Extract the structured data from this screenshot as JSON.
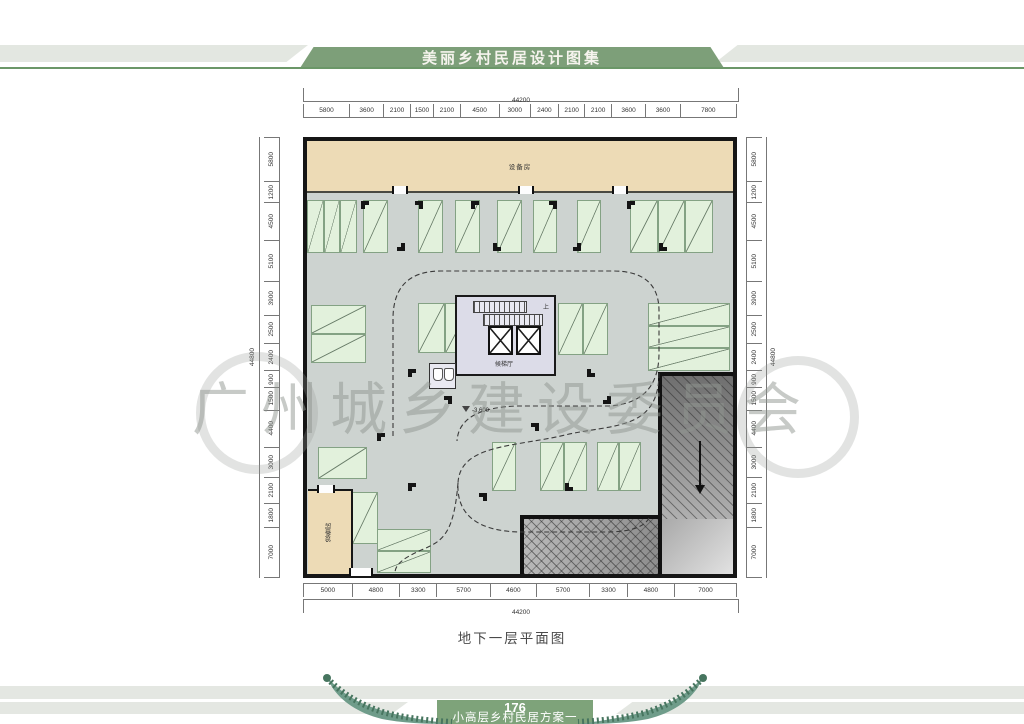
{
  "header": {
    "title": "美丽乡村民居设计图集"
  },
  "watermark": "广州城乡建设委员会",
  "caption": "地下一层平面图",
  "footer": {
    "page": "176",
    "subtitle": "小高层乡村民居方案一"
  },
  "plan": {
    "rooms": {
      "equipment_top": "设备房",
      "equipment_left": "设备房",
      "lobby": "候梯厅",
      "up": "上",
      "level": "-3.600"
    },
    "dimensions": {
      "top": {
        "overall": "44200",
        "segments": [
          "5800",
          "3600",
          "2100",
          "1500",
          "2100",
          "4500",
          "3000",
          "2400",
          "2100",
          "2100",
          "3600",
          "3600",
          "7800"
        ]
      },
      "bottom": {
        "overall": "44200",
        "segments": [
          "5000",
          "4800",
          "3300",
          "5700",
          "4600",
          "5700",
          "3300",
          "4800",
          "7000"
        ]
      },
      "left": {
        "overall": "44800",
        "segments": [
          "5800",
          "1200",
          "4500",
          "5100",
          "3900",
          "2500",
          "2400",
          "900",
          "1500",
          "4400",
          "3000",
          "2100",
          "1800",
          "7000"
        ]
      },
      "right": {
        "overall": "44800",
        "segments": [
          "5800",
          "1200",
          "4500",
          "5100",
          "3900",
          "2500",
          "2400",
          "900",
          "1500",
          "4400",
          "3000",
          "2100",
          "1800",
          "7000"
        ]
      }
    }
  },
  "colors": {
    "header_green": "#7d9f79",
    "rule_green": "#6b9768",
    "footer_green": "#7ea37a",
    "equipment_beige": "#eddbb6",
    "floor_gray": "#cdd3d0",
    "stall_green": "#e2f1dc",
    "core_fill": "#dcdce8",
    "wall": "#161616"
  }
}
